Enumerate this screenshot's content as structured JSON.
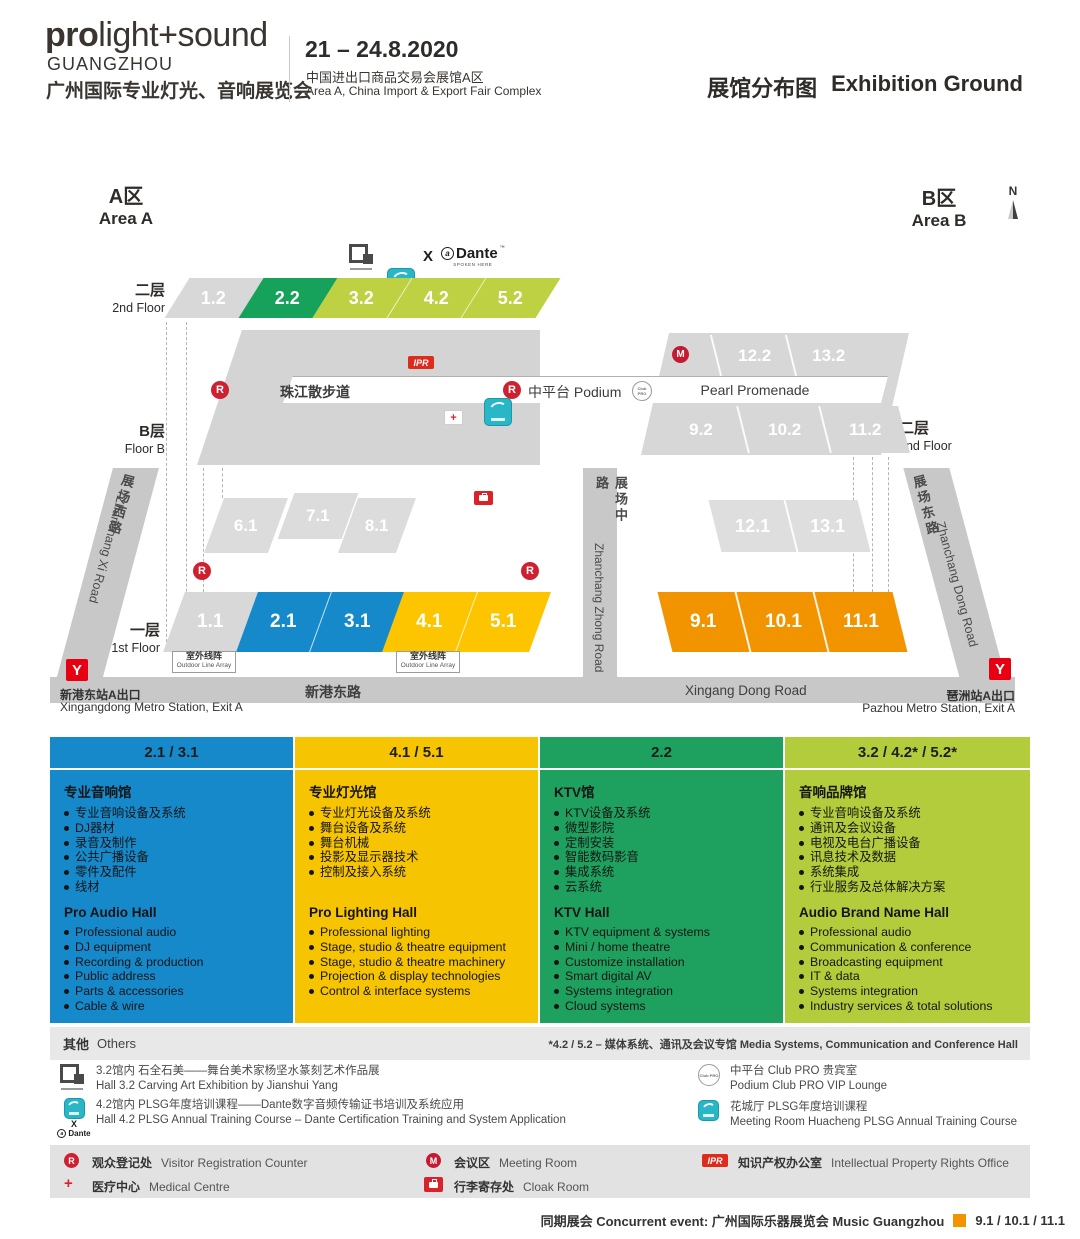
{
  "colors": {
    "blue": "#1689cb",
    "yellow": "#fcc500",
    "green": "#1ea15f",
    "lime": "#bdd142",
    "orange": "#f29400",
    "red": "#cf2030",
    "teal": "#29b6c6",
    "hall_gray": "#d8d8d8",
    "road_gray": "#c8c8c8"
  },
  "header": {
    "brand_bold": "pro",
    "brand_light": "light+sound",
    "brand_city": "GUANGZHOU",
    "brand_cn": "广州国际专业灯光、音响展览会",
    "dates": "21 – 24.8.2020",
    "venue_cn": "中国进出口商品交易会展馆A区",
    "venue_en": "Area A, China Import & Export Fair Complex",
    "title_cn": "展馆分布图",
    "title_en": "Exhibition Ground"
  },
  "map": {
    "area_a_cn": "A区",
    "area_a_en": "Area A",
    "area_b_cn": "B区",
    "area_b_en": "Area B",
    "north": "N",
    "floor2_cn": "二层",
    "floor2_en": "2nd Floor",
    "floorb_cn": "B层",
    "floorb_en": "Floor B",
    "floor1_cn": "一层",
    "floor1_en": "1st Floor",
    "floor2b_cn": "二层",
    "floor2b_en": "2nd Floor",
    "halls_2f": [
      "1.2",
      "2.2",
      "3.2",
      "4.2",
      "5.2"
    ],
    "halls_b2f_top": [
      "12.2",
      "13.2"
    ],
    "halls_b2f_bottom": [
      "9.2",
      "10.2",
      "11.2"
    ],
    "halls_a_mid": [
      "6.1",
      "7.1",
      "8.1"
    ],
    "halls_1f": [
      "1.1",
      "2.1",
      "3.1",
      "4.1",
      "5.1"
    ],
    "halls_b_mid": [
      "12.1",
      "13.1"
    ],
    "halls_b1f": [
      "9.1",
      "10.1",
      "11.1"
    ],
    "promenade_cn": "珠江散步道",
    "podium": "中平台 Podium",
    "pearl": "Pearl Promenade",
    "roads": {
      "xi_cn": "展场西路",
      "xi_en": "Zhanchang Xi Road",
      "zhong_cn": "展场中路",
      "zhong_en": "Zhanchang Zhong Road",
      "dong_cn": "展场东路",
      "dong_en": "Zhanchang Dong Road",
      "xingang_cn": "新港东路",
      "xingang_en": "Xingang Dong Road"
    },
    "outdoor_cn": "室外线阵",
    "outdoor_en": "Outdoor Line Array",
    "metro_left_cn": "新港东站A出口",
    "metro_left_en": "Xingangdong Metro Station, Exit A",
    "metro_right_cn": "琶洲站A出口",
    "metro_right_en": "Pazhou Metro Station, Exit A"
  },
  "icons": {
    "registration": "R",
    "meeting": "M",
    "ipr": "IPR",
    "multiply": "X",
    "dante": "Dante",
    "dante_sub": "SPOKEN HERE",
    "club_pro": "Club PRO"
  },
  "columns": [
    {
      "header": "2.1 / 3.1",
      "cn_title": "专业音响馆",
      "cn_items": [
        "专业音响设备及系统",
        "DJ器材",
        "录音及制作",
        "公共广播设备",
        "零件及配件",
        "线材"
      ],
      "en_title": "Pro Audio Hall",
      "en_items": [
        "Professional audio",
        "DJ equipment",
        "Recording & production",
        "Public address",
        "Parts & accessories",
        "Cable & wire"
      ]
    },
    {
      "header": "4.1 / 5.1",
      "cn_title": "专业灯光馆",
      "cn_items": [
        "专业灯光设备及系统",
        "舞台设备及系统",
        "舞台机械",
        "投影及显示器技术",
        "控制及接入系统"
      ],
      "en_title": "Pro Lighting Hall",
      "en_items": [
        "Professional lighting",
        "Stage, studio & theatre equipment",
        "Stage, studio & theatre machinery",
        "Projection & display technologies",
        "Control & interface systems"
      ]
    },
    {
      "header": "2.2",
      "cn_title": "KTV馆",
      "cn_items": [
        "KTV设备及系统",
        "微型影院",
        "定制安装",
        "智能数码影音",
        "集成系统",
        "云系统"
      ],
      "en_title": "KTV Hall",
      "en_items": [
        "KTV equipment & systems",
        "Mini / home theatre",
        "Customize installation",
        "Smart digital AV",
        "Systems integration",
        "Cloud systems"
      ]
    },
    {
      "header": "3.2 / 4.2* / 5.2*",
      "cn_title": "音响品牌馆",
      "cn_items": [
        "专业音响设备及系统",
        "通讯及会议设备",
        "电视及电台广播设备",
        "讯息技术及数据",
        "系统集成",
        "行业服务及总体解决方案"
      ],
      "en_title": "Audio Brand Name Hall",
      "en_items": [
        "Professional audio",
        "Communication & conference",
        "Broadcasting equipment",
        "IT & data",
        "Systems integration",
        "Industry services & total solutions"
      ]
    }
  ],
  "others": {
    "cn": "其他",
    "en": "Others",
    "note": "*4.2 / 5.2 – 媒体系统、通讯及会议专馆 Media Systems, Communication and Conference Hall"
  },
  "events": [
    {
      "line1": "3.2馆内  石全石美——舞台美术家杨坚水篆刻艺术作品展",
      "line2": "Hall 3.2  Carving Art Exhibition by Jianshui Yang"
    },
    {
      "line1": "4.2馆内  PLSG年度培训课程——Dante数字音频传输证书培训及系统应用",
      "line2": "Hall 4.2  PLSG Annual Training Course – Dante Certification Training and System Application"
    },
    {
      "line1": "中平台 Club PRO 贵宾室",
      "line2": "Podium Club PRO VIP Lounge"
    },
    {
      "line1": "花城厅  PLSG年度培训课程",
      "line2": "Meeting Room Huacheng PLSG Annual Training Course"
    }
  ],
  "facilities": [
    {
      "cn": "观众登记处",
      "en": "Visitor Registration Counter"
    },
    {
      "cn": "会议区",
      "en": "Meeting Room"
    },
    {
      "cn": "知识产权办公室",
      "en": "Intellectual Property Rights Office"
    },
    {
      "cn": "医疗中心",
      "en": "Medical Centre"
    },
    {
      "cn": "行李寄存处",
      "en": "Cloak Room"
    }
  ],
  "footer": {
    "concurrent": "同期展会 Concurrent event: 广州国际乐器展览会 Music Guangzhou",
    "halls": "9.1 / 10.1 / 11.1"
  }
}
